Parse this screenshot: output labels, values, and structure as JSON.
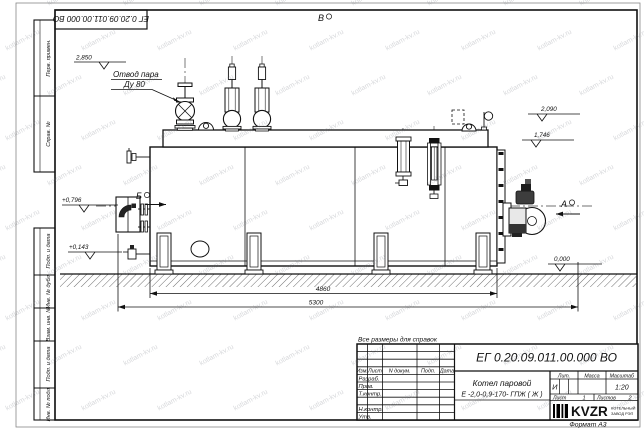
{
  "sheet": {
    "format_label": "Формат А3",
    "top_stamp_number": "ЕГ 0.20.09.011.00.000  ВО",
    "side_labels_top": [
      "Перв. примен.",
      "Справ. №"
    ],
    "side_labels_bottom": [
      "Подп. и дата",
      "Инв. № дубл.",
      "Взам. инв. №",
      "Подп. и дата",
      "Инв. № подл."
    ]
  },
  "watermark": {
    "text": "kotlam-kv.ru"
  },
  "drawing": {
    "reference_note": "Все размеры для справок",
    "labels": {
      "steam_outlet_line1": "Отвод пара",
      "steam_outlet_line2": "Ду 80",
      "view_top": "В",
      "view_left": "Б",
      "view_right": "А"
    },
    "elevations": {
      "top_valves": "2,850",
      "right_upper": "2,090",
      "right_lower": "1,746",
      "left_upper": "+0,796",
      "left_lower": "+0,143",
      "ground": "0,000"
    },
    "dimensions": {
      "body_length": "4860",
      "overall_length": "5300"
    }
  },
  "title_block": {
    "doc_number": "ЕГ 0.20.09.011.00.000  ВО",
    "product_line1": "Котел паровой",
    "product_line2": "Е -2,0-0,9-170- ГПЖ ( Ж )",
    "header_cols": [
      "Изм.",
      "Лист",
      "N докум.",
      "Подп.",
      "Дата"
    ],
    "sig_rows": [
      "Разраб.",
      "Пров.",
      "Т.контр.",
      "Н.контр.",
      "Утв."
    ],
    "lit_label": "Лит.",
    "lit_value": "И",
    "mass_label": "Масса",
    "scale_label": "Масштаб",
    "scale_value": "1:20",
    "sheet_label": "Лист",
    "sheet_value": "1",
    "sheets_label": "Листов",
    "sheets_value": "2",
    "company_name": "KVZR",
    "company_sub1": "КОТЕЛЬНЫЙ",
    "company_sub2": "ЗАВОД РЭП"
  }
}
